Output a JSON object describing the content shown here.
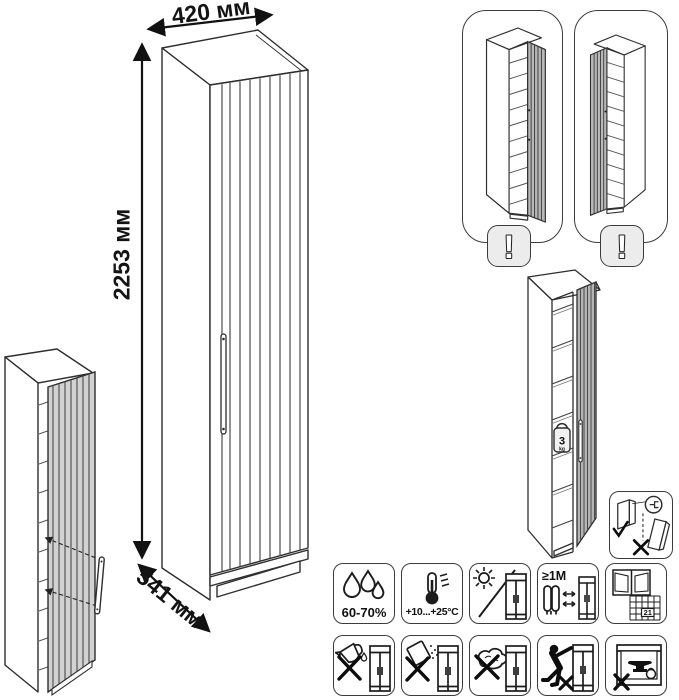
{
  "product": {
    "width_label": "420 мм",
    "height_label": "2253 мм",
    "depth_label": "541 мм",
    "shelf_load_value": "3",
    "shelf_load_unit": "kg"
  },
  "variants": {
    "left": {
      "warning": "!"
    },
    "right": {
      "warning": "!"
    }
  },
  "care": {
    "humidity": "60-70%",
    "temperature": "+10...+25°С",
    "distance": "≥1М",
    "calendar_day": "21"
  },
  "colors": {
    "line": "#2e2e2e",
    "door_gray": "#c9c9c9",
    "badge_background": "#ececec"
  }
}
